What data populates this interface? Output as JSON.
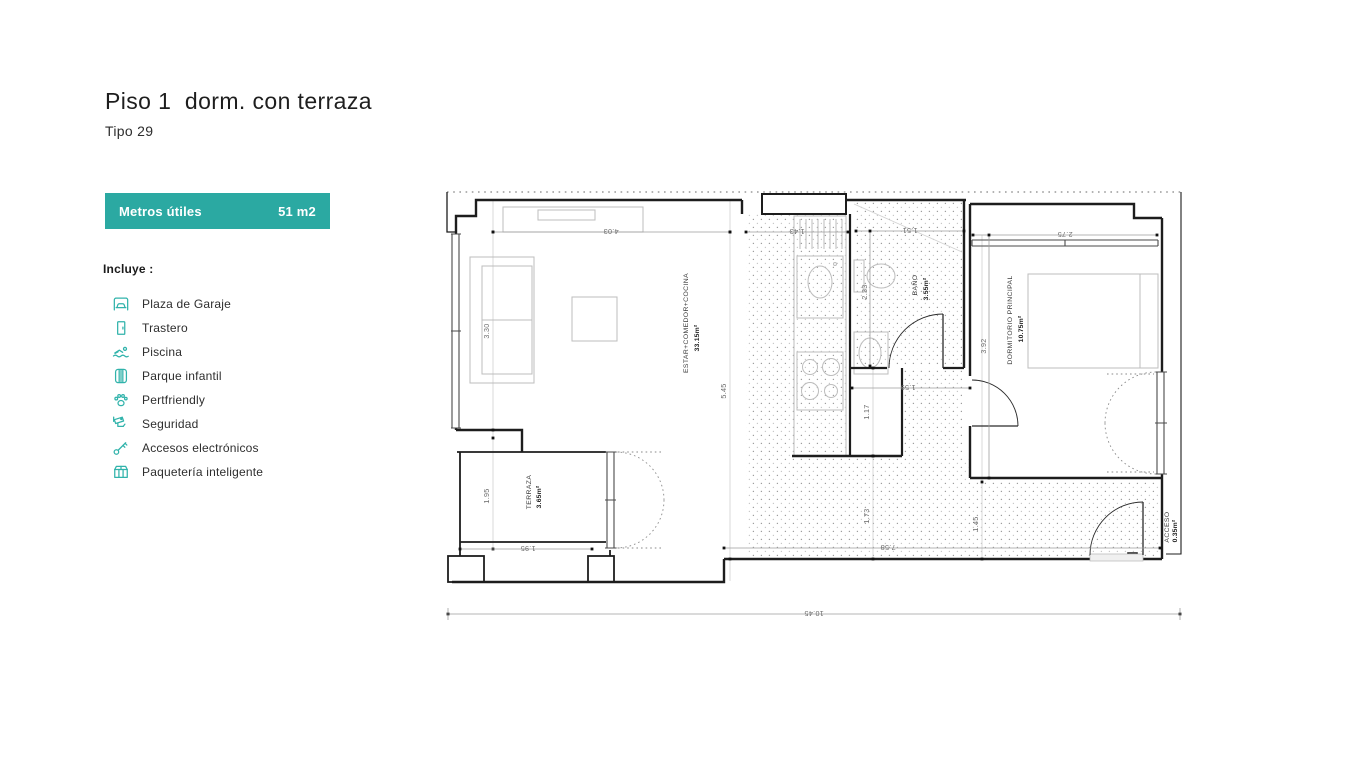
{
  "page": {
    "title": "Piso 1  dorm. con terraza",
    "subtitle": "Tipo 29"
  },
  "metrics": {
    "label": "Metros útiles",
    "value": "51 m2"
  },
  "includes": {
    "heading": "Incluye :",
    "items": [
      {
        "icon": "garage-icon",
        "label": "Plaza de Garaje"
      },
      {
        "icon": "storage-icon",
        "label": "Trastero"
      },
      {
        "icon": "pool-icon",
        "label": "Piscina"
      },
      {
        "icon": "playground-icon",
        "label": "Parque infantil"
      },
      {
        "icon": "paw-icon",
        "label": "Pertfriendly"
      },
      {
        "icon": "camera-icon",
        "label": "Seguridad"
      },
      {
        "icon": "key-icon",
        "label": "Accesos electrónicos"
      },
      {
        "icon": "parcel-icon",
        "label": "Paquetería inteligente"
      }
    ]
  },
  "floorplan": {
    "rooms": {
      "living": {
        "name": "ESTAR+COMEDOR+COCINA",
        "area": "33.15m²"
      },
      "bath": {
        "name": "BAÑO",
        "area": "3.55m²"
      },
      "bedroom": {
        "name": "DORMITORIO PRINCIPAL",
        "area": "10.75m²"
      },
      "terrace": {
        "name": "TERRAZA",
        "area": "3.65m²"
      },
      "access": {
        "name": "ACCESO",
        "area": "0.35m²"
      }
    },
    "dims": {
      "living_width": "4.03",
      "kitchen_width": "1.43",
      "bath_width": "1.51",
      "bedroom_width": "2.75",
      "living_window": "3.30",
      "living_depth": "5.45",
      "bath_depth": "2.33",
      "bedroom_depth": "3.92",
      "closet_depth": "1.17",
      "closet_width": "1.59",
      "terrace_depth": "1.95",
      "terrace_width": "1.95",
      "hall_depth": "1.73",
      "hall_width": "7.58",
      "entry_depth": "1.45",
      "total_width": "10.45"
    }
  },
  "colors": {
    "accent": "#2BA9A2",
    "accent_icon": "#31B3AB",
    "wall": "#1d1d1d"
  }
}
